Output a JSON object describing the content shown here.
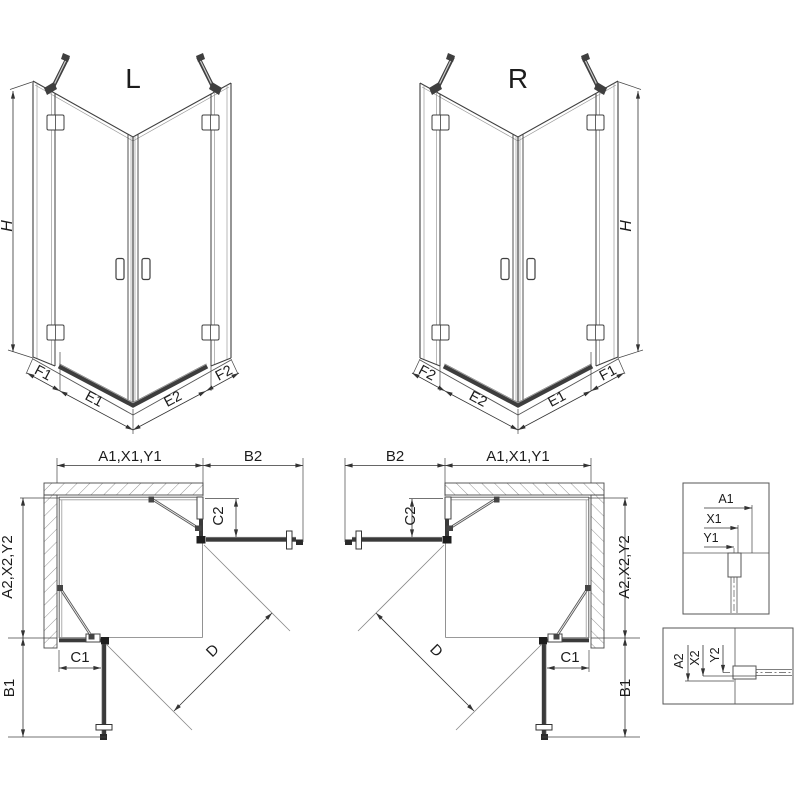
{
  "iso_left": {
    "view_label": "L",
    "height_label": "H",
    "seg_labels": [
      "F1",
      "E1",
      "E2",
      "F2"
    ]
  },
  "iso_right": {
    "view_label": "R",
    "height_label": "H",
    "seg_labels": [
      "F2",
      "E2",
      "E1",
      "F1"
    ]
  },
  "plan_left": {
    "top_label": "A1,X1,Y1",
    "top_right_label": "B2",
    "side_label": "A2,X2,Y2",
    "side_lower_label": "B1",
    "upper_door_label": "C2",
    "lower_door_label": "C1",
    "diagonal_label": "D"
  },
  "plan_right": {
    "top_left_label": "B2",
    "top_label": "A1,X1,Y1",
    "side_label": "A2,X2,Y2",
    "side_lower_label": "B1",
    "upper_door_label": "C2",
    "lower_door_label": "C1",
    "diagonal_label": "D"
  },
  "detail_upper": {
    "dim_labels": [
      "A1",
      "X1",
      "Y1"
    ]
  },
  "detail_lower": {
    "dim_labels": [
      "A2",
      "X2",
      "Y2"
    ]
  }
}
